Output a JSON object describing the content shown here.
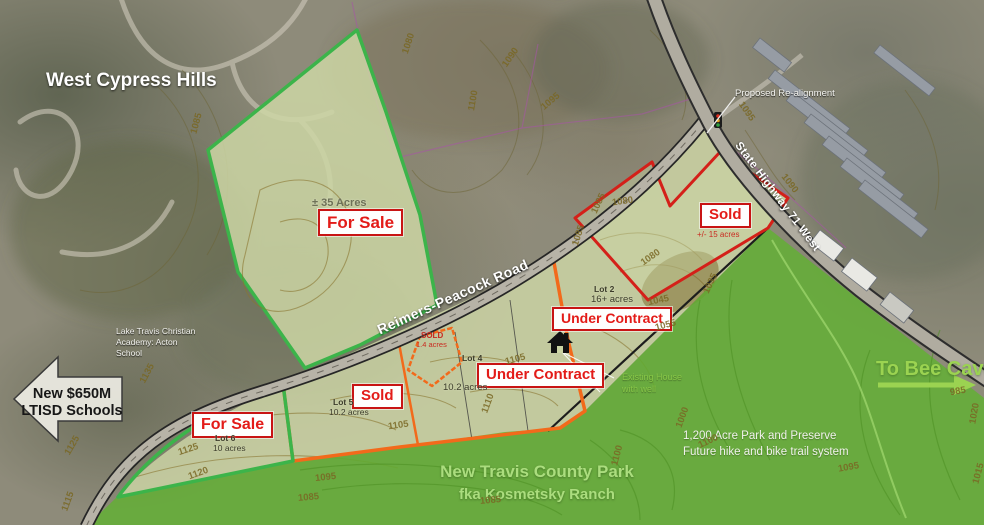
{
  "region_title": "West Cypress Hills",
  "roads": {
    "reimers_peacock": "Reimers-Peacock Road",
    "state_highway": "State Highway 71 West",
    "proposed_realignment": "Proposed Re-alignment"
  },
  "status_labels": {
    "for_sale_north": "For Sale",
    "for_sale_lot6": "For Sale",
    "sold_east": "Sold",
    "sold_lot5": "Sold",
    "under_contract_lot2": "Under Contract",
    "under_contract_lot4": "Under Contract",
    "sold_small": "SOLD",
    "sold_small_acres": "1.4 acres"
  },
  "acreage_notes": {
    "north_parcel": "± 35 Acres",
    "east_parcel": "+/- 15 acres"
  },
  "lots": [
    {
      "name": "Lot 2",
      "size": "16+ acres"
    },
    {
      "name": "Lot 4",
      "size": "10.2 acres"
    },
    {
      "name": "Lot 5",
      "size": "10.2 acres"
    },
    {
      "name": "Lot 6",
      "size": "10 acres"
    }
  ],
  "annotations": {
    "school_callout": {
      "line1": "Lake Travis Christian",
      "line2": "Academy: Acton",
      "line3": "School"
    },
    "ltisd_arrow": {
      "line1": "New $650M",
      "line2": "LTISD Schools"
    },
    "bee_cave_arrow": "To Bee Cave",
    "park_preserve": {
      "line1": "1,200 Acre Park and Preserve",
      "line2": "Future hike and bike trail system"
    },
    "county_park": {
      "line1": "New Travis County Park",
      "line2": "fka Kosmetsky Ranch"
    },
    "existing_house": {
      "line1": "Existing House",
      "line2": "with well"
    }
  },
  "contour_labels": [
    {
      "t": "1080",
      "x": 398,
      "y": 38,
      "r": -72
    },
    {
      "t": "1090",
      "x": 500,
      "y": 52,
      "r": -55
    },
    {
      "t": "1100",
      "x": 463,
      "y": 95,
      "r": -80
    },
    {
      "t": "1095",
      "x": 540,
      "y": 96,
      "r": -40
    },
    {
      "t": "1085",
      "x": 186,
      "y": 118,
      "r": -75
    },
    {
      "t": "1095",
      "x": 736,
      "y": 106,
      "r": 55
    },
    {
      "t": "1090",
      "x": 779,
      "y": 178,
      "r": 52
    },
    {
      "t": "1085",
      "x": 568,
      "y": 230,
      "r": -72
    },
    {
      "t": "1085",
      "x": 588,
      "y": 198,
      "r": -65
    },
    {
      "t": "1080",
      "x": 612,
      "y": 196,
      "r": -8
    },
    {
      "t": "1080",
      "x": 640,
      "y": 252,
      "r": -35
    },
    {
      "t": "1035",
      "x": 700,
      "y": 278,
      "r": -65
    },
    {
      "t": "1045",
      "x": 648,
      "y": 295,
      "r": -12
    },
    {
      "t": "1055",
      "x": 655,
      "y": 320,
      "r": -15
    },
    {
      "t": "1105",
      "x": 505,
      "y": 354,
      "r": -15
    },
    {
      "t": "1110",
      "x": 478,
      "y": 398,
      "r": -70
    },
    {
      "t": "1105",
      "x": 388,
      "y": 420,
      "r": -8
    },
    {
      "t": "1125",
      "x": 178,
      "y": 444,
      "r": -18
    },
    {
      "t": "1120",
      "x": 188,
      "y": 468,
      "r": -20
    },
    {
      "t": "1125",
      "x": 62,
      "y": 440,
      "r": -60
    },
    {
      "t": "1115",
      "x": 58,
      "y": 496,
      "r": -70
    },
    {
      "t": "1135",
      "x": 137,
      "y": 368,
      "r": -62
    },
    {
      "t": "1095",
      "x": 315,
      "y": 472,
      "r": -6
    },
    {
      "t": "1085",
      "x": 298,
      "y": 492,
      "r": -5
    },
    {
      "t": "1100",
      "x": 698,
      "y": 436,
      "r": -25
    },
    {
      "t": "1100",
      "x": 607,
      "y": 450,
      "r": -75
    },
    {
      "t": "1085",
      "x": 480,
      "y": 495,
      "r": -5
    },
    {
      "t": "1095",
      "x": 838,
      "y": 462,
      "r": -10
    },
    {
      "t": "985",
      "x": 950,
      "y": 386,
      "r": -10
    },
    {
      "t": "1020",
      "x": 964,
      "y": 408,
      "r": -80
    },
    {
      "t": "1000",
      "x": 672,
      "y": 412,
      "r": -70
    },
    {
      "t": "1015",
      "x": 968,
      "y": 468,
      "r": -75
    }
  ],
  "colors": {
    "status_red": "#d62a1e",
    "orange_boundary": "#f26a1b",
    "green_boundary": "#3cb44a",
    "red_boundary": "#d42019",
    "park_green": "#60b231",
    "highlight_green_text": "#9bd351",
    "contour_olive": "#7a6824",
    "lot_fill": "#cbd4a4"
  }
}
